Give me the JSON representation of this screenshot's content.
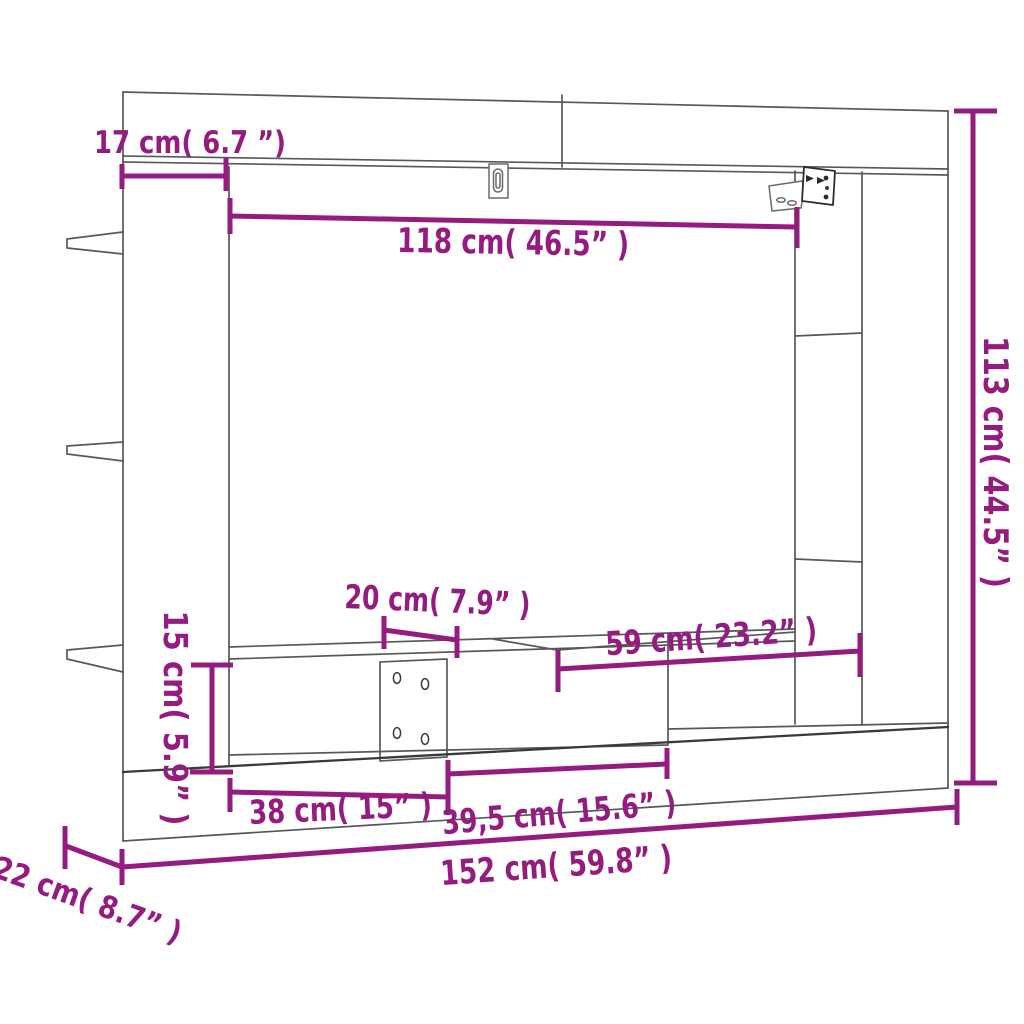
{
  "diagram": {
    "type": "furniture-dimension-diagram",
    "subject": "wall-mounted TV cabinet line drawing",
    "background": "#ffffff",
    "colors": {
      "dimension": "#951B81",
      "outline": "#58585a"
    },
    "dims": {
      "top_offset": {
        "cm": "17",
        "in": "6.7",
        "label": "17 cm( 6.7 ”)"
      },
      "inner_width": {
        "cm": "118",
        "in": "46.5",
        "label": "118 cm( 46.5” )"
      },
      "total_height": {
        "cm": "113",
        "in": "44.5",
        "label": "113 cm( 44.5” )"
      },
      "shelf_depth": {
        "cm": "20",
        "in": "7.9",
        "label": "20 cm( 7.9” )"
      },
      "niche_width": {
        "cm": "59",
        "in": "23.2",
        "label": "59 cm( 23.2” )"
      },
      "shelf_height": {
        "cm": "15",
        "in": "5.9",
        "label": "15 cm( 5.9” )"
      },
      "left_compartment_width": {
        "cm": "38",
        "in": "15",
        "label": "38 cm( 15” )"
      },
      "right_compartment_width": {
        "cm": "39,5",
        "in": "15.6",
        "label": "39,5 cm( 15.6” )"
      },
      "total_width": {
        "cm": "152",
        "in": "59.8",
        "label": "152 cm( 59.8” )"
      },
      "depth": {
        "cm": "22",
        "in": "8.7",
        "label": "22 cm( 8.7” )"
      }
    },
    "icons": [
      "mount-bracket-icon",
      "keyhole-slot-icon",
      "screw-holes"
    ]
  }
}
